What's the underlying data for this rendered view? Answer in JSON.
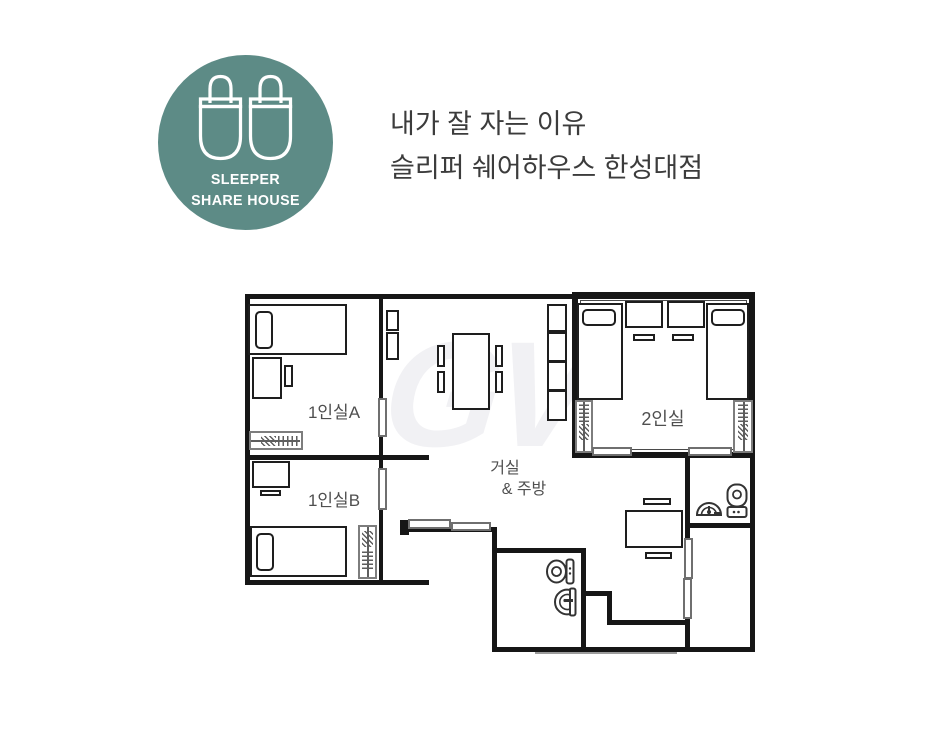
{
  "page": {
    "background": "#ffffff"
  },
  "logo": {
    "line1": "SLEEPER",
    "line2": "SHARE HOUSE",
    "brand_color": "#5d8b86",
    "icon": "slippers-icon"
  },
  "heading": {
    "line1": "내가 잘 자는 이유",
    "line2": "슬리퍼 쉐어하우스 한성대점",
    "color": "#3c3c3c"
  },
  "floorplan": {
    "watermark": "GV",
    "wall_color": "#161616",
    "furniture_outline_color": "#1e1e1e",
    "gray_accent_color": "#7d7d7d",
    "label_color": "#4f4f4f",
    "rooms": [
      {
        "label": "1인실A"
      },
      {
        "label": "1인실B"
      },
      {
        "label": "2인실"
      },
      {
        "label_line1": "거실",
        "label_line2": "& 주방"
      }
    ],
    "icons": {
      "logo": "slippers-icon",
      "bathroom_center": [
        "toilet-icon",
        "sink-icon"
      ],
      "bathroom_right": [
        "sink-icon",
        "toilet-icon"
      ]
    }
  }
}
